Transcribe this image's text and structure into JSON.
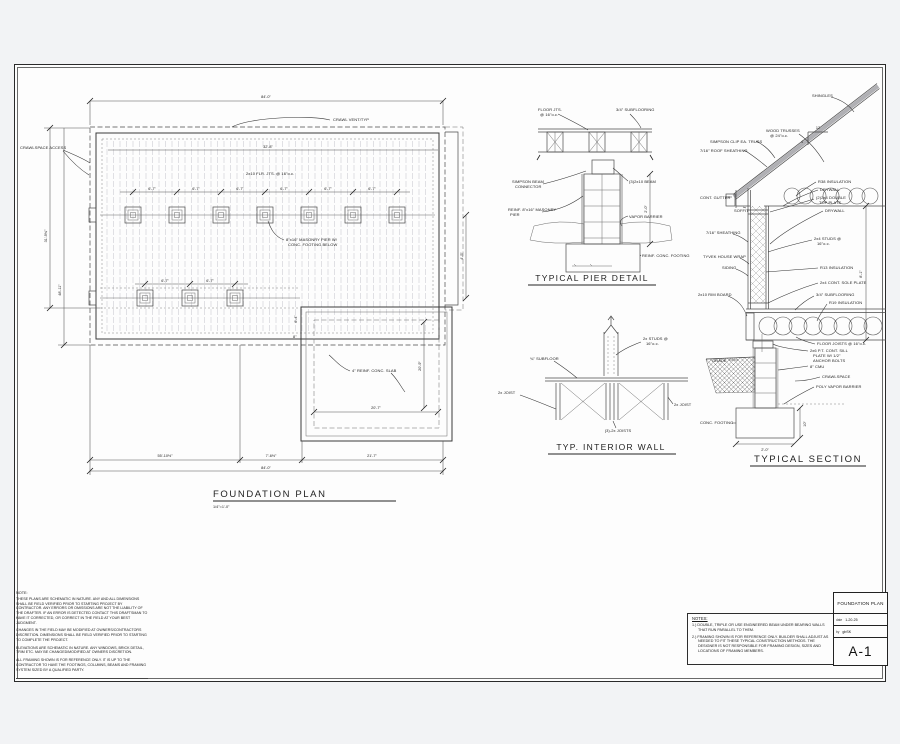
{
  "foundation_plan": {
    "title": "FOUNDATION PLAN",
    "scale": "1/4\"=1'-0\"",
    "dim_top": "84'-0\"",
    "dim_inner_top": "32'-8\"",
    "dim_left_inner": "31'-9¾\"",
    "dim_left_outer": "48'-11\"",
    "dim_right_bump": "4'-5\"",
    "dim_pier_spacing": "6'-7\"",
    "dim_bottom_1": "55'-10½\"",
    "dim_bottom_2": "7'-6½\"",
    "dim_bottom_3": "21'-7\"",
    "dim_bottom_total": "84'-0\"",
    "dim_garage_w": "20'-7\"",
    "dim_garage_h": "20'-9\"",
    "dim_step_h": "6'-4\"",
    "dim_step_w": "8\"",
    "label_crawl_vent": "CRAWL VENT/TYP",
    "label_crawlspace_access": "CRAWLSPACE ACCESS",
    "label_joists": "2x10 FLR. JTS. @ 16\"o.c.",
    "label_pier_1": "8\"x16\" MASONRY PIER W/",
    "label_pier_2": "CONC. FOOTING BELOW",
    "label_slab": "4\" REINF. CONC. SLAB"
  },
  "pier_detail": {
    "title": "TYPICAL PIER DETAIL",
    "label_floor_jts_1": "FLOOR JTS.",
    "label_floor_jts_2": "@ 16\"o.c.",
    "label_subflooring": "3/4\" SUBFLOORING",
    "label_connector_1": "SIMPSON BEAM",
    "label_connector_2": "CONNECTOR",
    "label_beam": "(3)2x10 BEAM",
    "label_pier_1": "REINF. 8\"x16\" MASONRY",
    "label_pier_2": "PIER",
    "label_vapor": "VAPOR BARRIER",
    "label_footing": "REINF. CONC. FOOTING",
    "dim_depth": "2'-0\""
  },
  "interior_wall": {
    "title": "TYP. INTERIOR WALL",
    "label_studs_1": "2x STUDS @",
    "label_studs_2": "16\"o.c.",
    "label_subfloor": "¾\" SUBFLOOR",
    "label_joist": "2x JOIST",
    "label_joists_center": "(3)-2x JOISTS"
  },
  "typical_section": {
    "title": "TYPICAL SECTION",
    "label_shingles": "SHINGLES",
    "pitch_run": "12",
    "pitch_rise": "4",
    "label_trusses_1": "WOOD TRUSSES",
    "label_trusses_2": "@ 24\"o.c.",
    "label_simpson": "SIMPSON CLIP EA. TRUSS",
    "label_roof_sheathing": "7/16\" ROOF SHEATHING",
    "label_gutter": "CONT. GUTTER",
    "label_soffit": "SOFFIT",
    "label_r38": "R38 INSULATION",
    "label_drywall_ceiling": "DRYWALL",
    "label_top_plate_1": "(2)2x4 DOUBLE",
    "label_top_plate_2": "TOP PLATE",
    "label_drywall_wall": "DRYWALL",
    "label_wall_sheathing": "7/16\" SHEATHING",
    "label_studs_1": "2x4 STUDS @",
    "label_studs_2": "16\"o.c.",
    "label_housewrap": "TYVEK HOUSE WRAP",
    "label_siding": "SIDING",
    "label_r13": "R13 INSULATION",
    "label_sole_plate": "2x4 CONT. SOLE PLATE",
    "label_subflooring": "3/4\" SUBFLOORING",
    "label_r19": "R19 INSULATION",
    "label_rim": "2x10 RIM BOARD",
    "label_floor_joists": "FLOOR JOISTS @ 16\"o.c.",
    "label_sill_1": "2x6 P.T. CONT. SILL",
    "label_sill_2": "PLATE W/ 1/2\"",
    "label_sill_3": "ANCHOR BOLTS",
    "label_cmu": "8\" CMU",
    "label_grade": "GRADE",
    "label_crawlspace": "CRAWLSPACE",
    "label_vapor": "POLY VAPOR BARRIER",
    "label_footing": "CONC. FOOTING",
    "dim_footing_w": "2'-0\"",
    "dim_footing_h": "10\"",
    "dim_wall_h": "8'-1\""
  },
  "general_notes": {
    "title": "NOTE:",
    "p1": "THESE PLANS ARE SCHEMATIC IN NATURE. ANY AND ALL DIMENSIONS SHALL BE FIELD VERIFIED PRIOR TO STARTING PROJECT BY CONTRACTOR. ANY ERRORS OR OMISSIONS ARE NOT THE LIABILITY OF THE DRAFTER. IF AN ERROR IS DETECTED CONTACT THIS DRAFTSMAN TO HAVE IT CORRECTED, OR CORRECT IN THE FIELD AT YOUR BEST JUDGMENT.",
    "p2": "CHANGES IN THE FIELD MAY BE MODIFIED AT OWNERS/CONTRACTORS DISCRETION. DIMENSIONS SHALL BE FIELD VERIFIED PRIOR TO STARTING TO COMPLETE THE PROJECT.",
    "p3": "ELEVATIONS ARE SCHEMATIC IN NATURE. ANY WINDOWS, BRICK DETAIL, TRIM ETC. MAY BE CHANGED/MODIFIED AT OWNERS DISCRETION.",
    "p4": "ALL FRAMING SHOWN IS FOR REFERENCE ONLY. IT IS UP TO THE CONTRACTOR TO HAVE THE FOOTINGS, COLUMNS, BEAMS AND FRAMING SYSTEM SIZED BY A QUALIFIED PARTY."
  },
  "notes_box": {
    "title": "NOTES:",
    "item1": "1.) DOUBLE, TRIPLE OR USE ENGINEERED BEAM UNDER BEARING WALLS THAT RUN PARALLEL TO THEM.",
    "item2": "2.) FRAMING SHOWN IS FOR REFERENCE ONLY. BUILDER SHALL ADJUST AS NEEDED TO FIT THESE TYPICAL CONSTRUCTION METHODS. THE DESIGNER IS NOT RESPONSIBLE FOR FRAMING DESIGN, SIZES AND LOCATIONS OF FRAMING MEMBERS."
  },
  "title_block": {
    "project": "FOUNDATION PLAN",
    "date_label": "date",
    "date_value": "1-20-25",
    "by_label": "by",
    "by_value": "gbSK",
    "sheet": "A-1"
  }
}
